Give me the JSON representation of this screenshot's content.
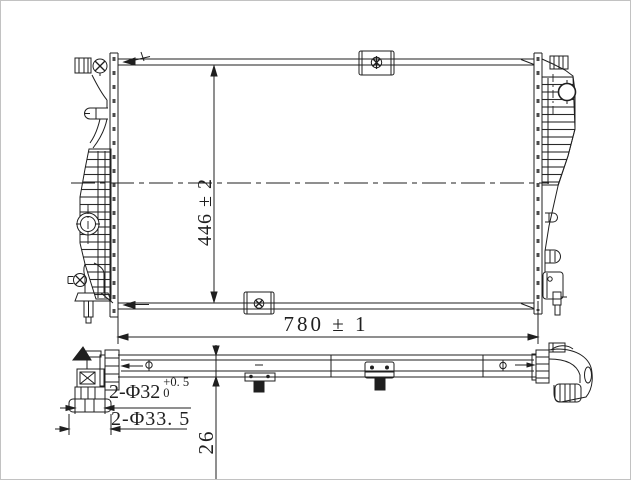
{
  "labels": {
    "core_height": "446 ± 2",
    "core_width": "780 ± 1",
    "core_thickness": "26",
    "inlet_inner_diameter": "2-Φ32",
    "inlet_inner_tol_upper": "+0. 5",
    "inlet_inner_tol_lower": "0",
    "inlet_outer_diameter": "2-Φ33. 5"
  },
  "colors": {
    "line": "#1f1f1f",
    "background": "#ffffff",
    "frame": "#c2c2c2"
  }
}
